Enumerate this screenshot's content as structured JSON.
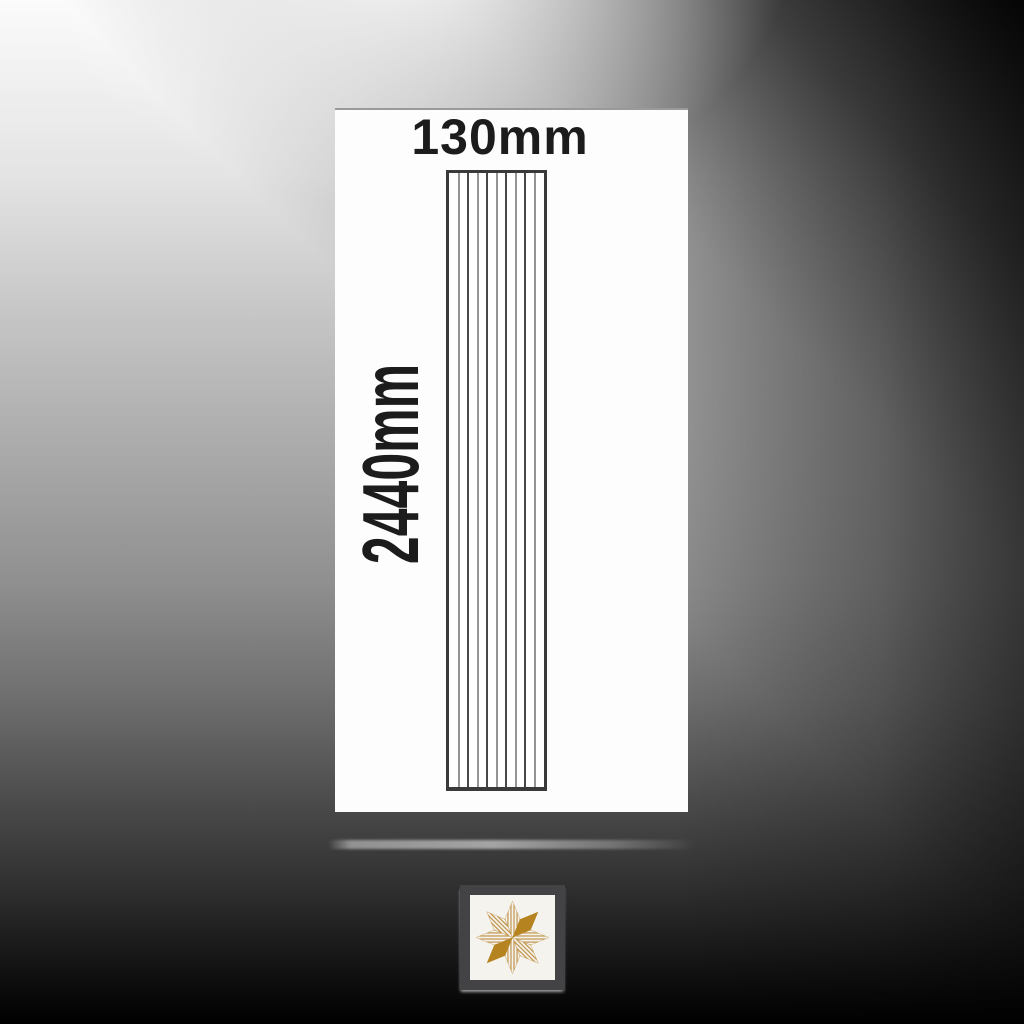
{
  "diagram": {
    "width_label": "130mm",
    "height_label": "2440mm"
  },
  "panel": {
    "slat_count": 10,
    "internal_line_count": 9
  },
  "logo": {
    "icon": "eight-point-star-icon",
    "solid_arms": [
      "NE",
      "SW"
    ],
    "striped_arms": [
      "N",
      "E",
      "S",
      "W",
      "NW",
      "SE"
    ]
  },
  "palette": {
    "card-bg": "#fdfdfd",
    "card-top-line": "#9a9a9a",
    "label-ink": "#1c1c1c",
    "panel-border": "#3a3a3a",
    "panel-line-dark": "#474747",
    "panel-line-light": "#949494",
    "logo-gold": "#b5831f",
    "logo-stripe": "#c49a55",
    "logo-bg": "#f5f3ed",
    "logo-frame": "#434346"
  }
}
